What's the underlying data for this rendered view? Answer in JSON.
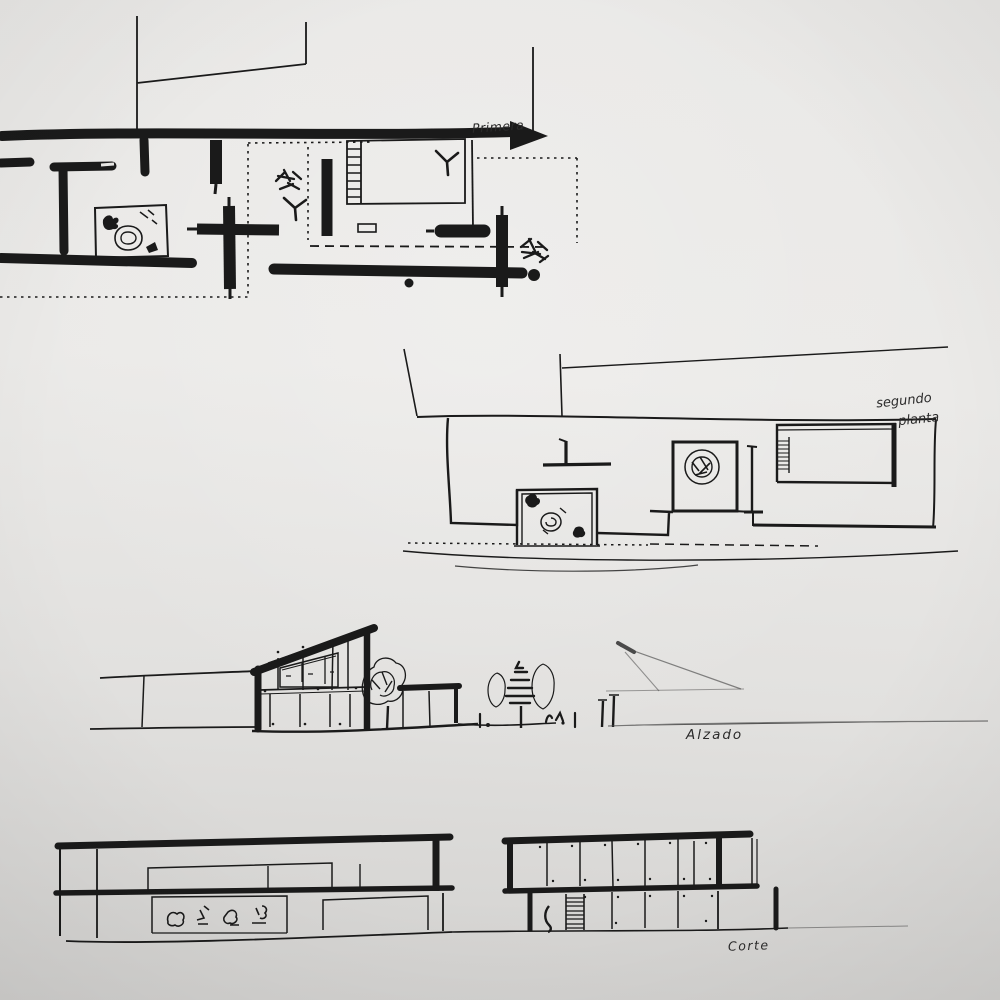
{
  "sheet": {
    "kind": "hand-drawn architectural sketch",
    "colors": {
      "paper_light": "#ebeae8",
      "paper_dark": "#d1d0ce",
      "ink": "#1a1a1a"
    }
  },
  "drawings": [
    {
      "id": "plan-first-floor",
      "type": "floor-plan",
      "label": "Primera"
    },
    {
      "id": "plan-second-floor",
      "type": "floor-plan",
      "label": "segundo planta",
      "label_lines": [
        "segundo",
        "planta"
      ]
    },
    {
      "id": "elevation",
      "type": "elevation",
      "label": "Alzado"
    },
    {
      "id": "section",
      "type": "section",
      "label": "Corte"
    }
  ]
}
